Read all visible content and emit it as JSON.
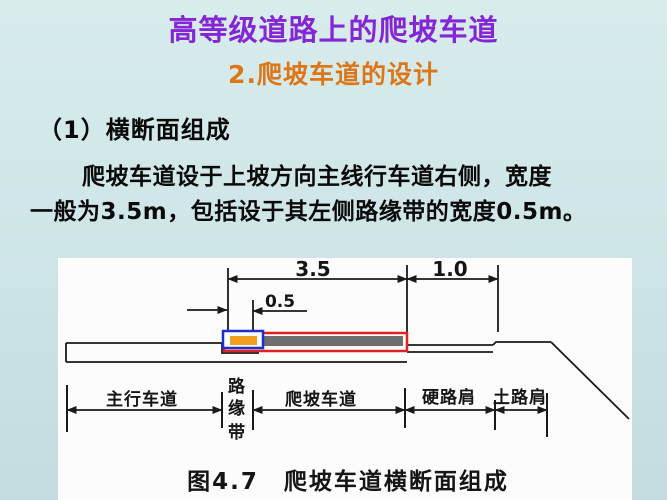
{
  "slide": {
    "title": "高等级道路上的爬坡车道",
    "subtitle": "2.爬坡车道的设计",
    "heading": "（1）横断面组成",
    "body_line1": "爬坡车道设于上坡方向主线行车道右侧，宽度",
    "body_line2": "一般为3.5m，包括设于其左侧路缘带的宽度0.5m。"
  },
  "figure": {
    "caption": "图4.7　爬坡车道横断面组成",
    "dimensions": {
      "climbing_lane_total_m": "3.5",
      "shoulder_m": "1.0",
      "curb_band_m": "0.5"
    },
    "labels": {
      "main_lane": "主行车道",
      "curb_band": "路缘带",
      "curb_band_chars": [
        "路",
        "缘",
        "带"
      ],
      "climbing_lane": "爬坡车道",
      "hard_shoulder": "硬路肩",
      "soil_shoulder": "土路肩"
    },
    "colors": {
      "curb_box": "#1f2fcc",
      "curb_fill": "#f0a01c",
      "lane_box": "#dd2222",
      "lane_fill": "#6e6e6e"
    }
  },
  "theme": {
    "background": "#cde4e6",
    "title_color": "#8426d6",
    "subtitle_color": "#dd7618"
  }
}
